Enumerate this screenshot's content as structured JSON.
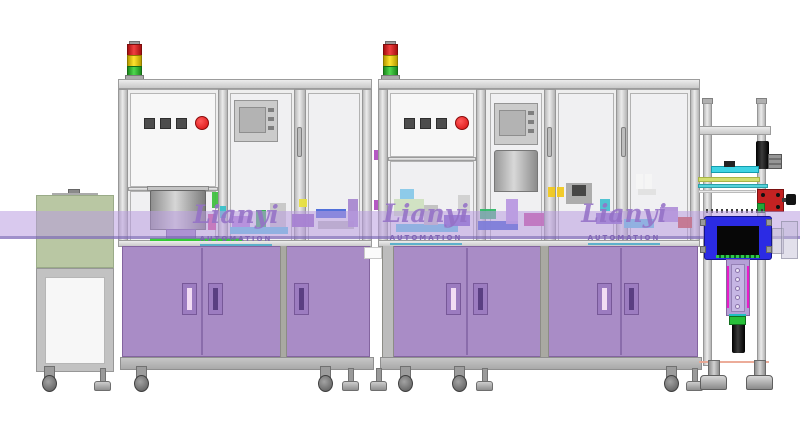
{
  "watermark": {
    "brand": "Lianyi",
    "subtitle": "AUTOMATION",
    "brand_color": "#9471c6",
    "underline_color": "#3ea6c8"
  },
  "colors": {
    "cabinet_purple": "#a98cc6",
    "conveyor_band": "rgba(186,156,224,0.55)",
    "infeed_cover_green": "#b9c7a3",
    "frame_gray": "#cfcfcf",
    "stack_red": "#e32222",
    "stack_yellow": "#ffe32e",
    "stack_green": "#3fc53f",
    "estop_red": "#d80f0f",
    "blue_module": "#2b2be4",
    "lilac_actuator": "#b4a0d6"
  },
  "components": {
    "infeed_module": "infeed-conveyor-module",
    "machine1": "assembly-machine-1",
    "machine2": "assembly-machine-2",
    "outfeed_station": "outfeed-camera-station",
    "stack_light_count": 2,
    "estop_count": 2
  },
  "decor": {
    "machinery": [
      {
        "x": 150,
        "y": 238,
        "w": 92,
        "h": 3,
        "c": "#2ecc2e"
      },
      {
        "x": 212,
        "y": 192,
        "w": 6,
        "h": 16,
        "c": "#40c040"
      },
      {
        "x": 208,
        "y": 214,
        "w": 8,
        "h": 16,
        "c": "#d04890"
      },
      {
        "x": 220,
        "y": 206,
        "w": 6,
        "h": 12,
        "c": "#38c0c8"
      },
      {
        "x": 230,
        "y": 227,
        "w": 58,
        "h": 7,
        "c": "#58c8e0"
      },
      {
        "x": 232,
        "y": 216,
        "w": 18,
        "h": 11,
        "c": "#b080d8"
      },
      {
        "x": 256,
        "y": 210,
        "w": 10,
        "h": 17,
        "c": "#30b050"
      },
      {
        "x": 270,
        "y": 203,
        "w": 16,
        "h": 24,
        "c": "#c6c6c6"
      },
      {
        "x": 292,
        "y": 214,
        "w": 22,
        "h": 13,
        "c": "#9060c0"
      },
      {
        "x": 299,
        "y": 199,
        "w": 8,
        "h": 8,
        "c": "#e8e040"
      },
      {
        "x": 316,
        "y": 209,
        "w": 30,
        "h": 9,
        "c": "#4868d8"
      },
      {
        "x": 318,
        "y": 221,
        "w": 36,
        "h": 8,
        "c": "#b8b8b8"
      },
      {
        "x": 348,
        "y": 199,
        "w": 10,
        "h": 28,
        "c": "#a888d0"
      },
      {
        "x": 374,
        "y": 150,
        "w": 4,
        "h": 10,
        "c": "#b050c0"
      },
      {
        "x": 374,
        "y": 200,
        "w": 4,
        "h": 10,
        "c": "#b050c0"
      },
      {
        "x": 394,
        "y": 199,
        "w": 30,
        "h": 17,
        "c": "#cfe0c0"
      },
      {
        "x": 400,
        "y": 189,
        "w": 14,
        "h": 10,
        "c": "#88c8e8"
      },
      {
        "x": 396,
        "y": 224,
        "w": 62,
        "h": 8,
        "c": "#58c8e0"
      },
      {
        "x": 424,
        "y": 205,
        "w": 14,
        "h": 20,
        "c": "#c0c0c0"
      },
      {
        "x": 444,
        "y": 215,
        "w": 26,
        "h": 11,
        "c": "#7858c8"
      },
      {
        "x": 458,
        "y": 195,
        "w": 12,
        "h": 18,
        "c": "#d0d0d0"
      },
      {
        "x": 478,
        "y": 221,
        "w": 40,
        "h": 9,
        "c": "#3858d0"
      },
      {
        "x": 480,
        "y": 209,
        "w": 16,
        "h": 10,
        "c": "#30b868"
      },
      {
        "x": 506,
        "y": 199,
        "w": 12,
        "h": 25,
        "c": "#b898e0"
      },
      {
        "x": 524,
        "y": 213,
        "w": 20,
        "h": 13,
        "c": "#c84898"
      },
      {
        "x": 548,
        "y": 187,
        "w": 7,
        "h": 10,
        "c": "#f0c820"
      },
      {
        "x": 557,
        "y": 187,
        "w": 7,
        "h": 10,
        "c": "#f0c820"
      },
      {
        "x": 566,
        "y": 183,
        "w": 26,
        "h": 21,
        "c": "#a8a8a8"
      },
      {
        "x": 572,
        "y": 185,
        "w": 14,
        "h": 11,
        "c": "#404040"
      },
      {
        "x": 596,
        "y": 213,
        "w": 26,
        "h": 11,
        "c": "#8868c8"
      },
      {
        "x": 600,
        "y": 199,
        "w": 10,
        "h": 12,
        "c": "#48c0d0"
      },
      {
        "x": 624,
        "y": 219,
        "w": 30,
        "h": 9,
        "c": "#58c8e0"
      },
      {
        "x": 636,
        "y": 174,
        "w": 7,
        "h": 15,
        "c": "#f4f4f4"
      },
      {
        "x": 645,
        "y": 174,
        "w": 7,
        "h": 15,
        "c": "#f4f4f4"
      },
      {
        "x": 638,
        "y": 189,
        "w": 18,
        "h": 6,
        "c": "#e0e0e0"
      },
      {
        "x": 660,
        "y": 207,
        "w": 18,
        "h": 15,
        "c": "#b090d8"
      },
      {
        "x": 678,
        "y": 217,
        "w": 14,
        "h": 11,
        "c": "#d04830"
      },
      {
        "x": 699,
        "y": 361,
        "w": 70,
        "h": 2,
        "c": "#eba894"
      }
    ],
    "feet": [
      {
        "x": 40,
        "t": "caster"
      },
      {
        "x": 94,
        "t": "leveler"
      },
      {
        "x": 132,
        "t": "caster"
      },
      {
        "x": 316,
        "t": "caster"
      },
      {
        "x": 342,
        "t": "leveler"
      },
      {
        "x": 370,
        "t": "leveler"
      },
      {
        "x": 396,
        "t": "caster"
      },
      {
        "x": 450,
        "t": "caster"
      },
      {
        "x": 476,
        "t": "leveler"
      },
      {
        "x": 662,
        "t": "caster"
      },
      {
        "x": 686,
        "t": "leveler"
      },
      {
        "x": 700,
        "t": "chunky"
      },
      {
        "x": 746,
        "t": "chunky"
      }
    ]
  }
}
